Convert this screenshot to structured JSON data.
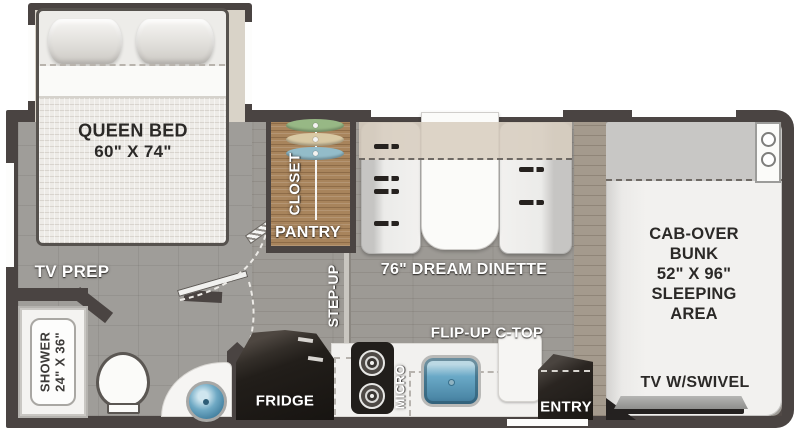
{
  "labels": {
    "queen_bed": {
      "line1": "QUEEN BED",
      "line2": "60\" X 74\""
    },
    "tv_prep": "TV PREP",
    "shower": {
      "line1": "SHOWER",
      "line2": "24\" X 36\""
    },
    "closet": "CLOSET",
    "pantry": "PANTRY",
    "step_up": "STEP-UP",
    "dinette": "76\" DREAM DINETTE",
    "flip_up_ctop": "FLIP-UP C-TOP",
    "fridge": "FRIDGE",
    "micro": "MICRO",
    "entry": "ENTRY",
    "cab_over_bunk": {
      "line1": "CAB-OVER",
      "line2": "BUNK",
      "line3": "52\" X 96\"",
      "line4": "SLEEPING",
      "line5": "AREA"
    },
    "tv_swivel": "TV W/SWIVEL"
  },
  "colors": {
    "wall": "#4a4442",
    "floor": "#9f9d99",
    "slideout_floor": "#d9d3c8",
    "closet_wood": "#a8845c",
    "overhead_band": "#d7cdc0",
    "sink_water": "#5f9fbf",
    "appliance_black": "#221e1b",
    "label_white": "#ffffff",
    "label_black": "#2b2927"
  }
}
